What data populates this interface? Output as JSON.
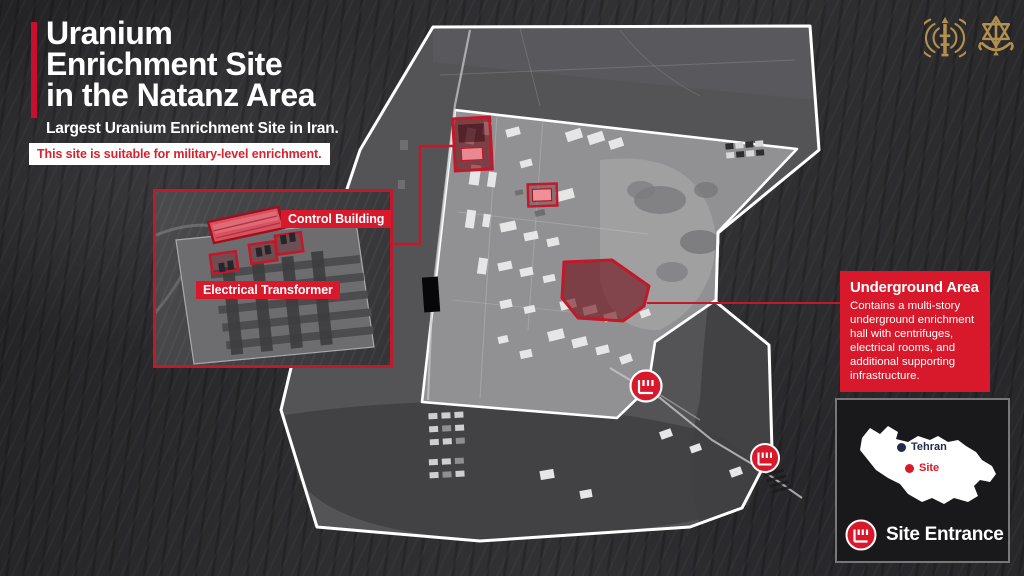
{
  "title": {
    "line1": "Uranium",
    "line2": "Enrichment Site",
    "line3": "in the Natanz Area"
  },
  "subtitle": "Largest Uranium Enrichment Site in Iran.",
  "banner": "This site is suitable for military-level enrichment.",
  "inset": {
    "control_building_label": "Control Building",
    "electrical_transformer_label": "Electrical Transformer"
  },
  "underground": {
    "title": "Underground Area",
    "body": "Contains a multi-story underground enrichment hall with centrifuges, electrical rooms, and additional supporting infrastructure."
  },
  "iran_inset": {
    "tehran_label": "Tehran",
    "site_label": "Site",
    "site_entrance_label": "Site Entrance"
  },
  "icons": {
    "entrance_marker": "gate-icon",
    "logo_left": "signal-corps-emblem",
    "logo_right": "idf-emblem"
  },
  "colors": {
    "accent_red": "#d8192b",
    "deep_red": "#c2182a",
    "dark_red_fill": "#6e0812",
    "banner_text_red": "#d8222f",
    "gold": "#b2914f",
    "tehran_navy": "#232949"
  }
}
